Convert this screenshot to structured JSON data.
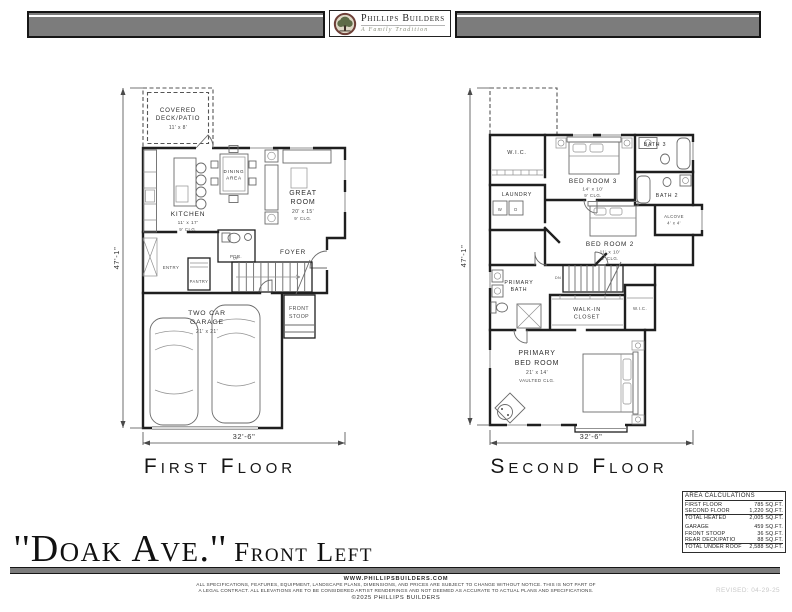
{
  "header": {
    "logo_name": "Phillips Builders",
    "logo_tagline": "A Family Tradition"
  },
  "plan_first": {
    "title": "First Floor",
    "dim_width": "32'-6\"",
    "dim_height": "47'-1\"",
    "deck": {
      "l1": "COVERED",
      "l2": "DECK/PATIO",
      "size": "11' x 8'"
    },
    "kitchen": {
      "name": "KITCHEN",
      "size": "11' x 17'",
      "clg": "9' CLG."
    },
    "dining": {
      "l1": "DINING",
      "l2": "AREA"
    },
    "great": {
      "l1": "GREAT",
      "l2": "ROOM",
      "size": "20' x 15'",
      "clg": "9' CLG."
    },
    "foyer": "FOYER",
    "pdr": "PDR.",
    "entry": "ENTRY",
    "pantry": "PANTRY",
    "garage": {
      "l1": "TWO CAR",
      "l2": "GARAGE",
      "size": "21' x 21'"
    },
    "stoop": {
      "l1": "FRONT",
      "l2": "STOOP"
    },
    "stairs": "UP"
  },
  "plan_second": {
    "title": "Second Floor",
    "dim_width": "32'-6\"",
    "dim_height": "47'-1\"",
    "wic_top": "W.I.C.",
    "laundry": "LAUNDRY",
    "washer": "W",
    "dryer": "D",
    "bed3": {
      "name": "BED ROOM 3",
      "size": "14' x 10'",
      "clg": "9' CLG."
    },
    "bath3": "BATH 3",
    "bath2": "BATH 2",
    "alcove": {
      "name": "ALCOVE",
      "size": "4' x 4'"
    },
    "bed2": {
      "name": "BED ROOM 2",
      "size": "11' x 10'",
      "clg": "9' CLG."
    },
    "pbath": {
      "l1": "PRIMARY",
      "l2": "BATH"
    },
    "closet": {
      "l1": "WALK-IN",
      "l2": "CLOSET"
    },
    "wic_right": "W.I.C.",
    "pbed": {
      "l1": "PRIMARY",
      "l2": "BED ROOM",
      "size": "21' x 14'",
      "clg": "VAULTED CLG."
    },
    "stairs": "DN"
  },
  "area_table": {
    "title": "AREA CALCULATIONS",
    "rows": [
      {
        "label": "FIRST FLOOR",
        "value": "785 SQ.FT."
      },
      {
        "label": "SECOND FLOOR",
        "value": "1,220 SQ.FT."
      },
      {
        "label": "TOTAL HEATED",
        "value": "2,005 SQ.FT."
      },
      {
        "label": "GARAGE",
        "value": "459 SQ.FT."
      },
      {
        "label": "FRONT STOOP",
        "value": "36 SQ.FT."
      },
      {
        "label": "REAR DECK/PATIO",
        "value": "88 SQ.FT."
      },
      {
        "label": "TOTAL UNDER ROOF",
        "value": "2,588 SQ.FT."
      }
    ]
  },
  "footer": {
    "plan_title": "''Doak Ave.''",
    "plan_subtitle": "Front Left",
    "revised": "REVISED: 04-29-25",
    "website": "WWW.PHILLIPSBUILDERS.COM",
    "disclaimer1": "ALL SPECIFICATIONS, FEATURES, EQUIPMENT, LANDSCAPE PLANS, DIMENSIONS, AND PRICES ARE SUBJECT TO CHANGE WITHOUT NOTICE. THIS IS NOT PART OF",
    "disclaimer2": "A LEGAL CONTRACT. ALL ELEVATIONS ARE TO BE CONSIDERED ARTIST RENDERINGS AND NOT DEEMED AS ACCURATE TO ACTUAL PLANS AND SPECIFICATIONS.",
    "copyright": "©2025 PHILLIPS BUILDERS"
  }
}
